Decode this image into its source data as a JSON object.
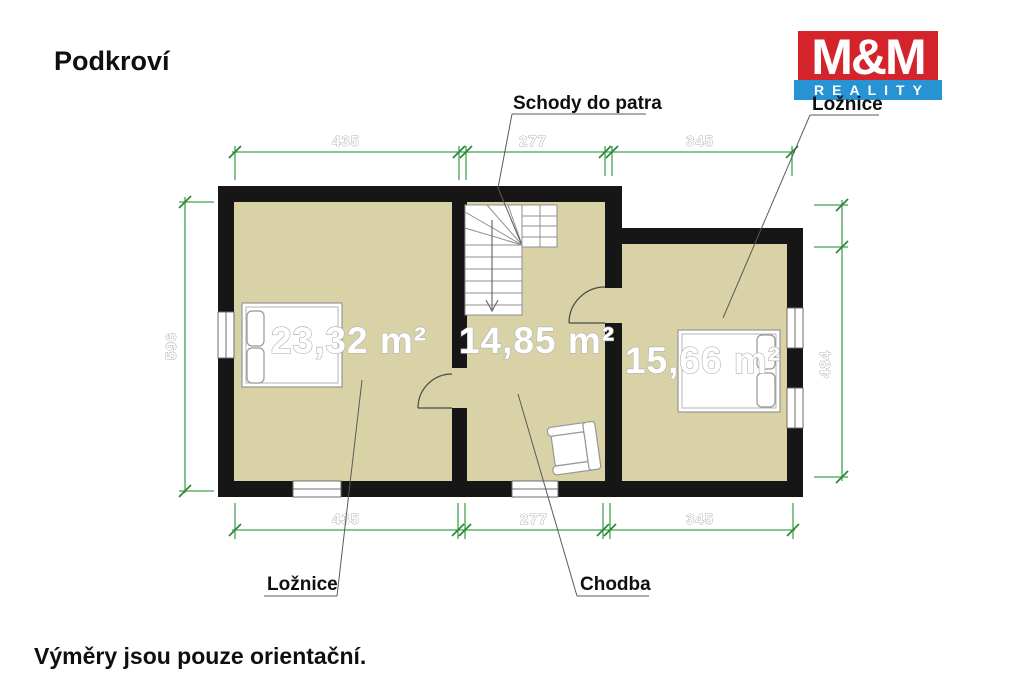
{
  "page": {
    "title": "Podkroví",
    "footer": "Výměry jsou pouze orientační."
  },
  "logo": {
    "line1": "M&M",
    "line2": "REALITY",
    "red": "#d4232a",
    "blue": "#2793d3"
  },
  "plan": {
    "callouts": {
      "stairs": "Schody do patra",
      "bedroom_right": "Ložnice",
      "bedroom_left": "Ložnice",
      "hallway": "Chodba"
    },
    "rooms": [
      {
        "name": "Ložnice",
        "area": "23,32 m²"
      },
      {
        "name": "Chodba",
        "area": "14,85 m²"
      },
      {
        "name": "Ložnice",
        "area": "15,66 m²"
      }
    ],
    "dimensions": {
      "top": [
        "435",
        "277",
        "345"
      ],
      "bottom": [
        "435",
        "277",
        "345"
      ],
      "left": "596",
      "right": "484"
    },
    "colors": {
      "wall": "#161616",
      "floor": "#d8d2a6",
      "dimension_line": "#44a04f"
    }
  }
}
